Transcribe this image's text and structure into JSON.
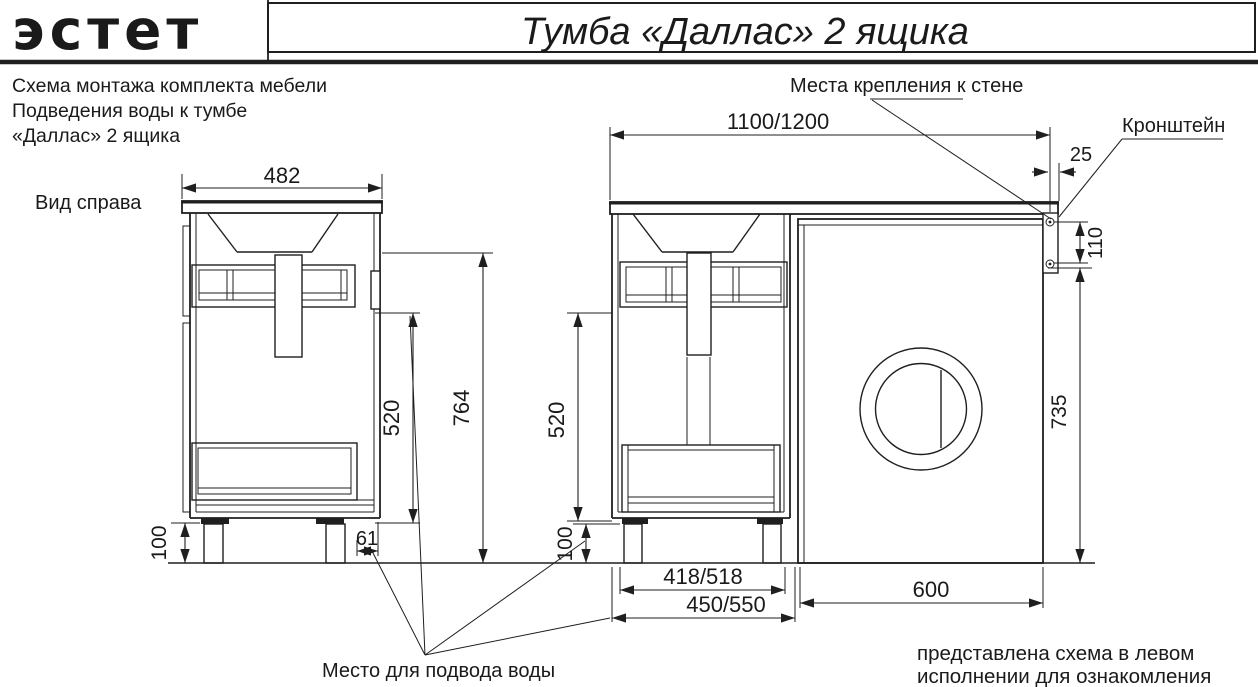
{
  "header": {
    "logo_text": "эстет",
    "title": "Тумба «Даллас» 2 ящика"
  },
  "description": {
    "line1": "Схема монтажа комплекта мебели",
    "line2": "Подведения воды к тумбе",
    "line3": "«Даллас» 2 ящика"
  },
  "labels": {
    "view_side": "Вид справа",
    "wall_mount": "Места крепления к стене",
    "bracket": "Кронштейн",
    "water_supply": "Место для подвода воды"
  },
  "dimensions": {
    "side_width": "482",
    "side_water_height": "520",
    "side_total_height": "764",
    "side_leg_height": "100",
    "side_back_gap": "61",
    "front_total_width": "1100/1200",
    "front_overhang": "25",
    "bracket_hole_spacing": "110",
    "front_water_height": "520",
    "front_leg_height": "100",
    "washer_height": "735",
    "washer_width": "600",
    "front_inner_width": "418/518",
    "front_outer_width": "450/550"
  },
  "disclaimer": {
    "line1": "представлена схема в левом",
    "line2": "исполнении для ознакомления",
    "color": "#cc5254"
  }
}
